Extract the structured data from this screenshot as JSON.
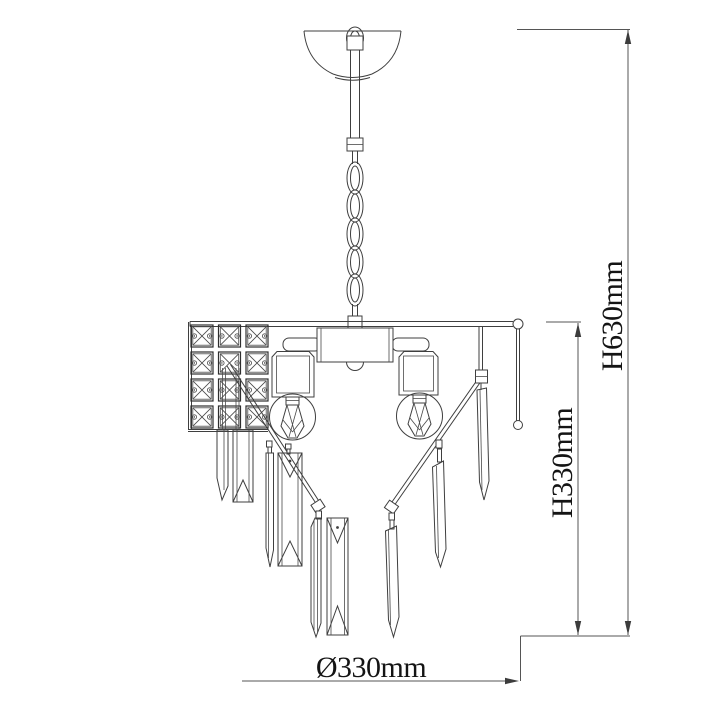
{
  "diagram": {
    "subject": "chandelier technical line drawing",
    "dimensions": {
      "total_height_label": "H630mm",
      "body_height_label": "H330mm",
      "diameter_label": "Ø330mm"
    },
    "style": {
      "background": "#ffffff",
      "line_color": "#3f3f3f",
      "dimension_line_color": "#555555",
      "text_color": "#141414"
    },
    "parts": [
      "hanging loop",
      "ceiling canopy",
      "suspension stem",
      "chain",
      "frame bar",
      "crystal grid panel",
      "central hub",
      "lamp shades",
      "exposed bulbs",
      "diagonal arms",
      "crystal prism pendants"
    ]
  }
}
